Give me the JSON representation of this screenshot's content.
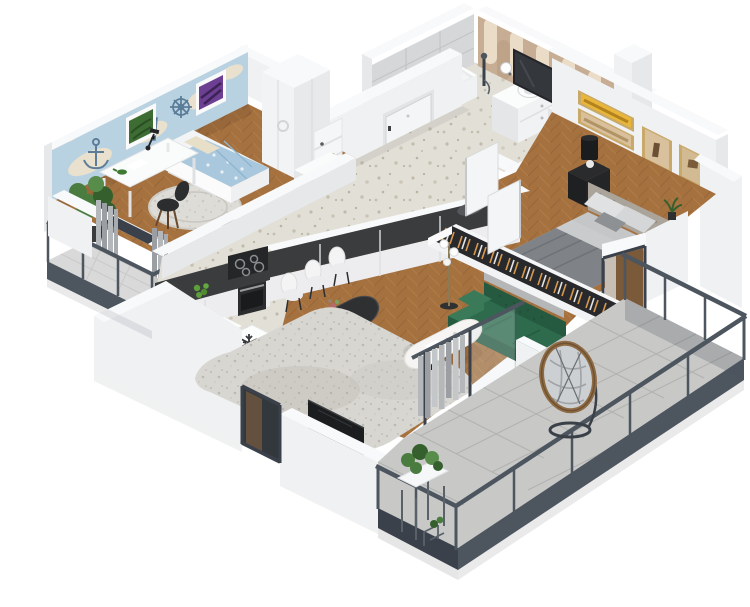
{
  "meta": {
    "title": "3D isometric apartment floor plan render",
    "view": "axonometric cutaway, white background, no visible text"
  },
  "palette": {
    "bg": "#ffffff",
    "wall_top": "#f8f9fa",
    "wall_light": "#f0f1f3",
    "wall_mid": "#e6e8ea",
    "wall_shade": "#d9dcdf",
    "slate": "#4d555f",
    "slate_dark": "#3a414b",
    "wood": "#a5713f",
    "wood_dark": "#8a5a31",
    "wood_light": "#b9844d",
    "terrazzo": "#e2dfd7",
    "terrazzo_dot": "#c0bbac",
    "tile": "#c8c9c7",
    "grout": "#b2b3b1",
    "counter": "#3b3c3e",
    "cabinet": "#ededef",
    "sofa_green": "#2e6b4c",
    "sofa_green_dark": "#265a40",
    "sofa_green_light": "#3a7a59",
    "rug": "#d8d6d1",
    "rug_dark": "#b7b4ae",
    "wallpaper_blue": "#b9d2e2",
    "wallpaper_island": "#e9e1cd",
    "wallpaper_motif": "#5c7d98",
    "arch_tan": "#c7ad93",
    "arch_cream": "#eadcc6",
    "tilewall": "#d5d7d9",
    "tilewall_line": "#c2c5c8",
    "bed_duvet": "#7f8286",
    "bed_sheet": "#c9cbcd",
    "headboard": "#aba49b",
    "kids_duvet": "#a9c8dd",
    "pillow_cream": "#e8dfc8",
    "black": "#232528",
    "frame_gold": "#c9a96a",
    "art_yellow": "#e7b63b",
    "art_tan": "#d9c09a",
    "plant_green": "#4a7c3f",
    "plant_dark": "#35602e",
    "apple_green": "#5da03a",
    "curtain": "#b5b8bb",
    "curtain_dark": "#9b9ea2",
    "rattan": "#8f6b44",
    "door_white": "#f4f5f6",
    "tv_black": "#1c1d1f",
    "glass_dark": "#33383d"
  },
  "scene": {
    "rooms": [
      {
        "name": "kids-room",
        "floor": "herringbone-wood",
        "features": [
          "nautical-map-wallpaper",
          "two-art-frames",
          "single-bed",
          "desk",
          "black-chair",
          "potted-plant",
          "round-rug",
          "curtained-balcony-door"
        ]
      },
      {
        "name": "entry-hall",
        "floor": "terrazzo",
        "features": [
          "entry-door",
          "tall-wardrobe",
          "open-shelf",
          "dresser",
          "two-open-doors"
        ]
      },
      {
        "name": "bathroom",
        "floor": "terrazzo",
        "features": [
          "gray-tile-wall",
          "arch-pattern-wall",
          "bathtub",
          "shower-fixture",
          "vanity-with-round-sink",
          "mirror",
          "two-globe-lamps",
          "washing-machine",
          "black-toilet"
        ]
      },
      {
        "name": "bedroom",
        "floor": "herringbone-wood",
        "features": [
          "tufted-headboard-double-bed",
          "four-art-frames",
          "black-nightstand",
          "black-lamp",
          "balcony-door"
        ]
      },
      {
        "name": "kitchen",
        "floor": "terrazzo",
        "features": [
          "dark-L-counter",
          "induction-hob",
          "oven",
          "green-apples",
          "fridge-with-snowflake",
          "white-cabinets"
        ]
      },
      {
        "name": "dining-area",
        "floor": "terrazzo",
        "features": [
          "dark-marble-oval-table",
          "six-white-chairs",
          "vase",
          "yellow-plate"
        ]
      },
      {
        "name": "living-room",
        "floor": "herringbone-wood",
        "features": [
          "green-sofa",
          "white-oval-coffee-table",
          "textured-gray-rug",
          "floor-lamp",
          "open-clothes-rack",
          "gray-curtains",
          "wall-tv",
          "glazed-doors"
        ]
      },
      {
        "name": "main-terrace",
        "floor": "gray-tiles",
        "features": [
          "glass-railing",
          "hanging-egg-chair",
          "plant-stands"
        ]
      },
      {
        "name": "left-balcony",
        "floor": "gray-tiles",
        "features": [
          "glass-railing"
        ]
      }
    ]
  }
}
